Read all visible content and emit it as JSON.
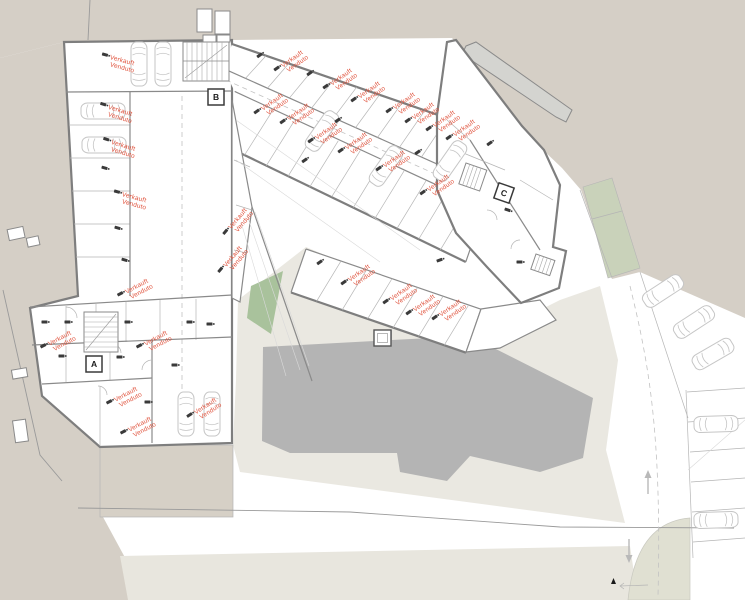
{
  "document": {
    "type": "architectural-floor-plan",
    "subject": "Basement parking garage and cellar level with sold-unit annotations",
    "languages": [
      "de",
      "it"
    ]
  },
  "legend": {
    "sold_line1": "Verkauft",
    "sold_line2": "Venduto"
  },
  "stair_cores": [
    {
      "label": "A",
      "x": 94,
      "y": 364,
      "rot": 0
    },
    {
      "label": "B",
      "x": 216,
      "y": 97,
      "rot": 0
    },
    {
      "label": "C",
      "x": 504,
      "y": 193,
      "rot": 19
    }
  ],
  "sold_units": [
    {
      "x": 117,
      "y": 62,
      "rot": 15
    },
    {
      "x": 115,
      "y": 112,
      "rot": 17
    },
    {
      "x": 118,
      "y": 147,
      "rot": 17
    },
    {
      "x": 129,
      "y": 199,
      "rot": 15
    },
    {
      "x": 134,
      "y": 291,
      "rot": -28
    },
    {
      "x": 57,
      "y": 343,
      "rot": -28
    },
    {
      "x": 153,
      "y": 343,
      "rot": -28
    },
    {
      "x": 123,
      "y": 399,
      "rot": -28
    },
    {
      "x": 137,
      "y": 429,
      "rot": -28
    },
    {
      "x": 203,
      "y": 411,
      "rot": -33
    },
    {
      "x": 237,
      "y": 224,
      "rot": -50
    },
    {
      "x": 232,
      "y": 262,
      "rot": -50
    },
    {
      "x": 290,
      "y": 64,
      "rot": -35
    },
    {
      "x": 339,
      "y": 82,
      "rot": -35
    },
    {
      "x": 367,
      "y": 95,
      "rot": -35
    },
    {
      "x": 402,
      "y": 106,
      "rot": -35
    },
    {
      "x": 421,
      "y": 116,
      "rot": -35
    },
    {
      "x": 442,
      "y": 124,
      "rot": -35
    },
    {
      "x": 462,
      "y": 133,
      "rot": -35
    },
    {
      "x": 270,
      "y": 107,
      "rot": -35
    },
    {
      "x": 296,
      "y": 117,
      "rot": -35
    },
    {
      "x": 324,
      "y": 136,
      "rot": -35
    },
    {
      "x": 354,
      "y": 146,
      "rot": -35
    },
    {
      "x": 392,
      "y": 164,
      "rot": -35
    },
    {
      "x": 436,
      "y": 188,
      "rot": -35
    },
    {
      "x": 357,
      "y": 278,
      "rot": -35
    },
    {
      "x": 399,
      "y": 297,
      "rot": -35
    },
    {
      "x": 422,
      "y": 308,
      "rot": -35
    },
    {
      "x": 448,
      "y": 313,
      "rot": -35
    }
  ],
  "unit_markers": [
    {
      "x": 105,
      "y": 168,
      "rot": 15
    },
    {
      "x": 118,
      "y": 228,
      "rot": 15
    },
    {
      "x": 125,
      "y": 260,
      "rot": 15
    },
    {
      "x": 45,
      "y": 322,
      "rot": 0
    },
    {
      "x": 68,
      "y": 322,
      "rot": 0
    },
    {
      "x": 128,
      "y": 322,
      "rot": 0
    },
    {
      "x": 190,
      "y": 322,
      "rot": 0
    },
    {
      "x": 210,
      "y": 324,
      "rot": 0
    },
    {
      "x": 62,
      "y": 356,
      "rot": 0
    },
    {
      "x": 120,
      "y": 357,
      "rot": 0
    },
    {
      "x": 148,
      "y": 402,
      "rot": 0
    },
    {
      "x": 260,
      "y": 55,
      "rot": -35
    },
    {
      "x": 310,
      "y": 73,
      "rot": -35
    },
    {
      "x": 338,
      "y": 120,
      "rot": -35
    },
    {
      "x": 305,
      "y": 160,
      "rot": -35
    },
    {
      "x": 418,
      "y": 152,
      "rot": -35
    },
    {
      "x": 490,
      "y": 143,
      "rot": -35
    },
    {
      "x": 508,
      "y": 210,
      "rot": 19
    },
    {
      "x": 520,
      "y": 262,
      "rot": 0
    },
    {
      "x": 320,
      "y": 262,
      "rot": -35
    },
    {
      "x": 440,
      "y": 260,
      "rot": -20
    },
    {
      "x": 175,
      "y": 365,
      "rot": 0
    }
  ],
  "cars": [
    {
      "x": 139,
      "y": 64,
      "rot": 0
    },
    {
      "x": 163,
      "y": 64,
      "rot": 0
    },
    {
      "x": 103,
      "y": 111,
      "rot": 90
    },
    {
      "x": 104,
      "y": 145,
      "rot": 90
    },
    {
      "x": 186,
      "y": 414,
      "rot": 0
    },
    {
      "x": 212,
      "y": 414,
      "rot": 0
    },
    {
      "x": 322,
      "y": 131,
      "rot": 35
    },
    {
      "x": 386,
      "y": 166,
      "rot": 35
    },
    {
      "x": 450,
      "y": 161,
      "rot": 35
    },
    {
      "x": 663,
      "y": 291,
      "rot": 57
    },
    {
      "x": 694,
      "y": 322,
      "rot": 57
    },
    {
      "x": 713,
      "y": 354,
      "rot": 60
    },
    {
      "x": 716,
      "y": 424,
      "rot": 88
    },
    {
      "x": 716,
      "y": 520,
      "rot": 88
    }
  ],
  "flow_arrows": [
    {
      "x": 648,
      "y": 482,
      "dir": "up"
    },
    {
      "x": 629,
      "y": 551,
      "dir": "down"
    }
  ],
  "colors": {
    "terrain": "#d5cfc6",
    "terrace": "#eae8e1",
    "tan": "#d6d0c6",
    "bottom_strip": "#e8e6de",
    "roof_grey": "#b4b4b4",
    "green": "#a9c29c",
    "green_strip": "#c9d2ba",
    "sage": "#e0e0d2",
    "wall": "#7e7e7e",
    "line": "#b5b5b5",
    "sold_red": "#e0523c",
    "car_outline": "#c6c6c6",
    "marker_dark": "#3a3a3a"
  }
}
